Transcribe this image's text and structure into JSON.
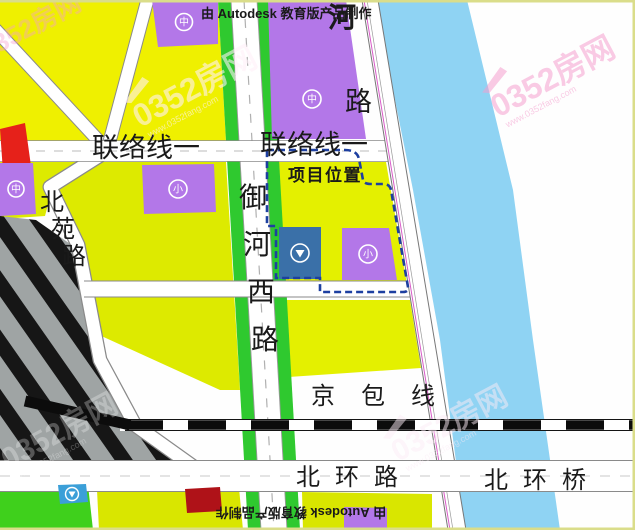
{
  "titles": {
    "top": "由 Autodesk 教育版产品制作",
    "bottom": "由 Autodesk 教育版产品制作"
  },
  "project": {
    "label": "项目位置"
  },
  "roads": {
    "lianluo_left": "联络线一",
    "lianluo_right": "联络线一",
    "yuhexi": [
      "御",
      "河",
      "西",
      "路"
    ],
    "beiyuan": [
      "北",
      "苑",
      "路"
    ],
    "riverside": [
      "河",
      "路"
    ],
    "jingbao": "京包线",
    "beihuan_road": "北环路",
    "beihuan_bridge": "北环桥"
  },
  "icons": {
    "middle_school": "中",
    "primary_school": "小",
    "market": "▼"
  },
  "watermark": {
    "brand": "0352房网",
    "url": "www.0352fang.com"
  },
  "colors": {
    "parcel_yellow": "#EFF000",
    "parcel_chartreuse": "#DDEA00",
    "parcel_green": "#3FD01C",
    "school_purple": "#B377E8",
    "river_blue": "#8FD3F3",
    "block_blue": "#3A70A8",
    "block_cyan": "#3B9FD8",
    "block_red": "#E6211A",
    "block_darkred": "#AF1218",
    "road_green_strip": "#2FC92F",
    "boundary_navy": "#1D3FA0",
    "yard_gray": "#9FA4A4"
  }
}
